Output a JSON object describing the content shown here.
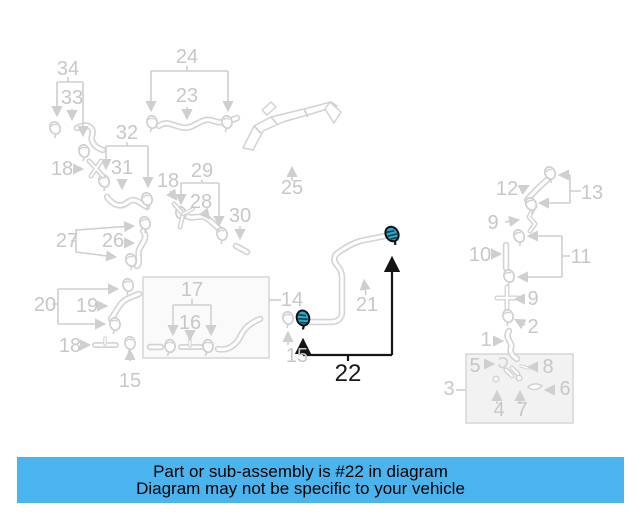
{
  "banner": {
    "line1": "Part or sub-assembly is #22 in diagram",
    "line2": "Diagram may not be specific to your vehicle",
    "bg_color": "#4ab4ef",
    "text_color": "#000000"
  },
  "diagram": {
    "highlighted_part": "22",
    "highlight_fill": "#2fa9cb",
    "line_color": "#d2d2d2",
    "label_color": "#c7c7c7",
    "callouts": {
      "c34": "34",
      "c33": "33",
      "c24": "24",
      "c23": "23",
      "c32": "32",
      "c31": "31",
      "c18a": "18",
      "c18b": "18",
      "c18c": "18",
      "c29": "29",
      "c28": "28",
      "c30": "30",
      "c25": "25",
      "c27": "27",
      "c26": "26",
      "c12": "12",
      "c13": "13",
      "c9a": "9",
      "c9b": "9",
      "c10": "10",
      "c11": "11",
      "c20": "20",
      "c19": "19",
      "c17": "17",
      "c16": "16",
      "c14": "14",
      "c15a": "15",
      "c15b": "15",
      "c21": "21",
      "c2": "2",
      "c1": "1",
      "c5": "5",
      "c8": "8",
      "c3": "3",
      "c6": "6",
      "c4": "4",
      "c7": "7",
      "c22": "22"
    }
  }
}
